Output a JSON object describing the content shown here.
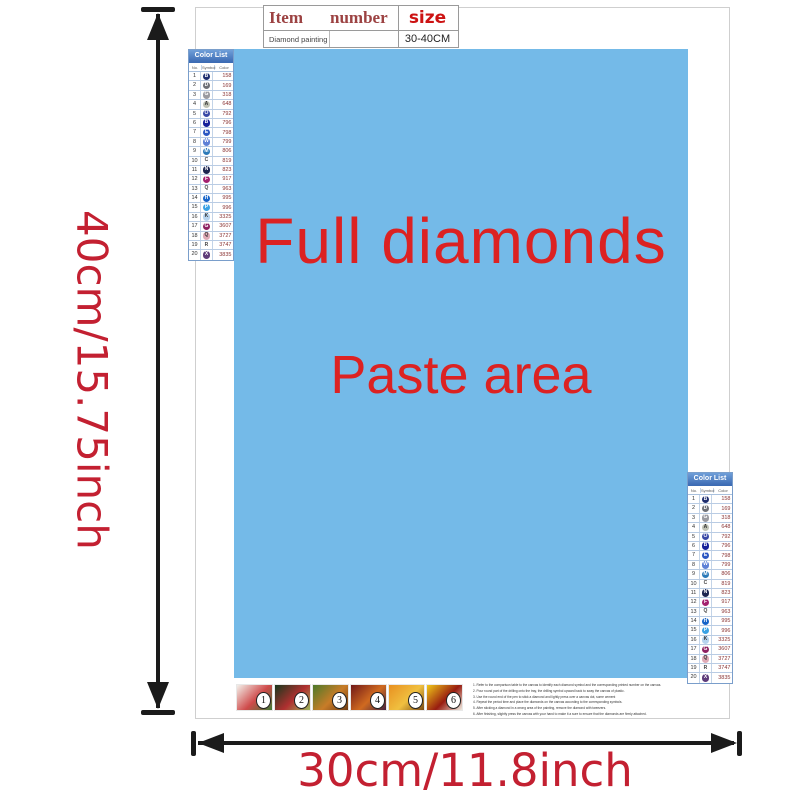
{
  "labels": {
    "height": "40cm/15.75inch",
    "width": "30cm/11.8inch",
    "dimension_color": "#c32031",
    "arrow_color": "#1b1b1b"
  },
  "item_table": {
    "col_item": "Item",
    "col_number": "number",
    "col_size": "size",
    "row_item": "Diamond painting",
    "row_number": "",
    "row_size": "30-40CM"
  },
  "paste_area": {
    "line1": "Full diamonds",
    "line2": "Paste area",
    "bg": "#74bae8",
    "text_color": "#dc2222"
  },
  "color_list": {
    "title": "Color List",
    "cols": {
      "no": "No.",
      "symbol": "Symbol",
      "color": "Color"
    },
    "rows": [
      {
        "no": "1",
        "sym": "B",
        "code": "158",
        "bg": "#1e2d6e",
        "fg": "#ffffff"
      },
      {
        "no": "2",
        "sym": "D",
        "code": "169",
        "bg": "#6e7076",
        "fg": "#ffffff"
      },
      {
        "no": "3",
        "sym": "G",
        "code": "318",
        "bg": "#9a9aa0",
        "fg": "#ffffff"
      },
      {
        "no": "4",
        "sym": "A",
        "code": "648",
        "bg": "#bfc2b4",
        "fg": "#333333"
      },
      {
        "no": "5",
        "sym": "O",
        "code": "792",
        "bg": "#3a49a6",
        "fg": "#ffffff"
      },
      {
        "no": "6",
        "sym": "B",
        "code": "796",
        "bg": "#16219a",
        "fg": "#ffffff"
      },
      {
        "no": "7",
        "sym": "E",
        "code": "798",
        "bg": "#2b57c2",
        "fg": "#ffffff"
      },
      {
        "no": "8",
        "sym": "W",
        "code": "799",
        "bg": "#5d80d6",
        "fg": "#ffffff"
      },
      {
        "no": "9",
        "sym": "M",
        "code": "806",
        "bg": "#2a79b8",
        "fg": "#ffffff"
      },
      {
        "no": "10",
        "sym": "C",
        "code": "819",
        "bg": "",
        "fg": "#444444"
      },
      {
        "no": "11",
        "sym": "N",
        "code": "823",
        "bg": "#1c2550",
        "fg": "#ffffff"
      },
      {
        "no": "12",
        "sym": "F",
        "code": "917",
        "bg": "#a42270",
        "fg": "#ffffff"
      },
      {
        "no": "13",
        "sym": "Q",
        "code": "963",
        "bg": "",
        "fg": "#444444"
      },
      {
        "no": "14",
        "sym": "H",
        "code": "995",
        "bg": "#1563c8",
        "fg": "#ffffff"
      },
      {
        "no": "15",
        "sym": "P",
        "code": "996",
        "bg": "#3aa2e4",
        "fg": "#ffffff"
      },
      {
        "no": "16",
        "sym": "K",
        "code": "3325",
        "bg": "#b6d3ee",
        "fg": "#333333"
      },
      {
        "no": "17",
        "sym": "G",
        "code": "3607",
        "bg": "#8e2162",
        "fg": "#ffffff"
      },
      {
        "no": "18",
        "sym": "Q",
        "code": "3727",
        "bg": "#dfaab6",
        "fg": "#333333"
      },
      {
        "no": "19",
        "sym": "R",
        "code": "3747",
        "bg": "",
        "fg": "#444444"
      },
      {
        "no": "20",
        "sym": "X",
        "code": "3835",
        "bg": "#5e3c7a",
        "fg": "#ffffff"
      }
    ]
  },
  "steps": [
    {
      "label": "1",
      "colors": [
        "#f2f0ea",
        "#cf4a4a",
        "#3e7a33"
      ]
    },
    {
      "label": "2",
      "colors": [
        "#16381c",
        "#b03030",
        "#9db65a"
      ]
    },
    {
      "label": "3",
      "colors": [
        "#4c7a2a",
        "#c87c28",
        "#6e3c14"
      ]
    },
    {
      "label": "4",
      "colors": [
        "#701818",
        "#d06a20",
        "#46223e"
      ]
    },
    {
      "label": "5",
      "colors": [
        "#e89020",
        "#f0c040",
        "#7a4a14"
      ]
    },
    {
      "label": "6",
      "colors": [
        "#f0c818",
        "#981c10",
        "#efece2"
      ]
    }
  ],
  "instructions": [
    "1. Refer to the comparison table to the canvas to identify each diamond symbol and the corresponding printed number on the canvas.",
    "2. Pour round part of the drilling onto the tray, the drilling symbol upward back to sway the canvas of plastic.",
    "3. Use the round end of the pen to stick a diamond and lightly press over a canvas dot, some cement",
    "4. Repeat the period time and place the diamonds on the canvas according to the corresponding symbols.",
    "5. After sticking a diamond in a wrong area of the painting, remove the diamond with tweezers.",
    "6. After finishing, slightly press the canvas with your hand to make it a sure to ensure that the diamonds are firmly attached."
  ]
}
